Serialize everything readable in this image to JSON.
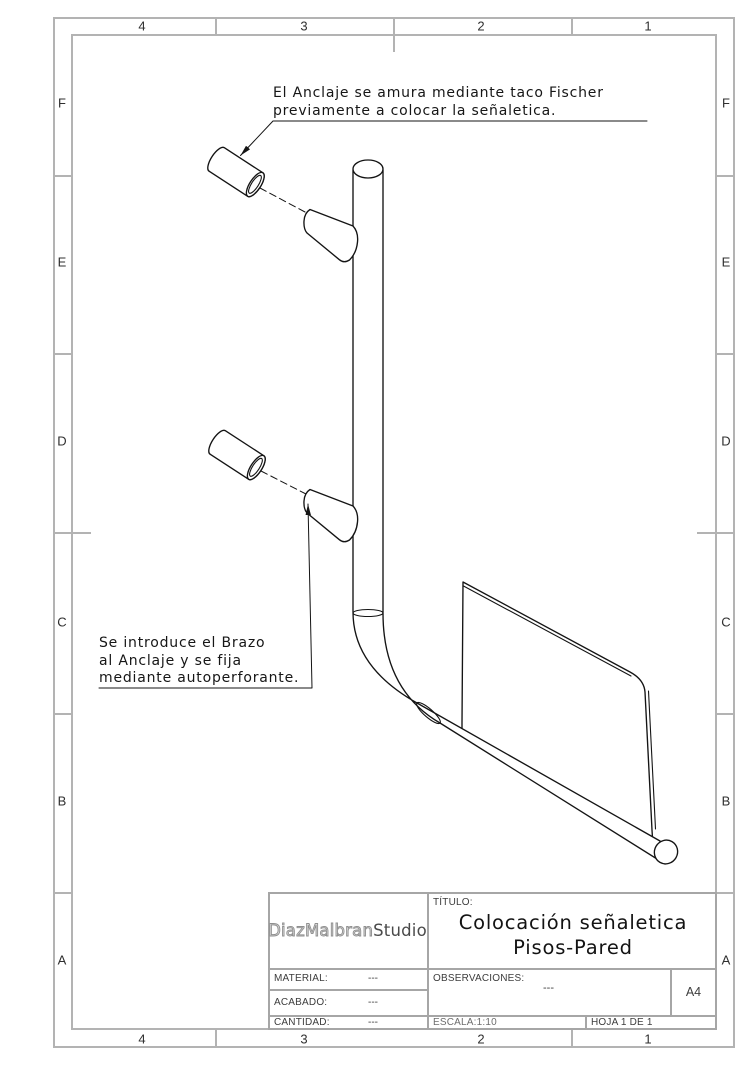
{
  "frame": {
    "columns": [
      "4",
      "3",
      "2",
      "1"
    ],
    "rows": [
      "F",
      "E",
      "D",
      "C",
      "B",
      "A"
    ],
    "border_color": "#b3b3b3"
  },
  "notes": {
    "anchor_note": {
      "line1": "El Anclaje se amura mediante taco Fischer",
      "line2": "previamente a colocar la señaletica."
    },
    "arm_note": {
      "line1": "Se introduce el Brazo",
      "line2": "al Anclaje y se fija",
      "line3": "mediante autoperforante."
    }
  },
  "title_block": {
    "logo": {
      "part1": "DiazMalbran",
      "part2": "Studio"
    },
    "titulo_label": "TÍTULO:",
    "title_line1": "Colocación señaletica",
    "title_line2": "Pisos-Pared",
    "material_label": "MATERIAL:",
    "material_value": "---",
    "acabado_label": "ACABADO:",
    "acabado_value": "---",
    "cantidad_label": "CANTIDAD:",
    "cantidad_value": "---",
    "observaciones_label": "OBSERVACIONES:",
    "observaciones_value": "---",
    "escala": "ESCALA:1:10",
    "hoja": "HOJA 1 DE 1",
    "paper_size": "A4"
  },
  "drawing": {
    "line_color": "#141414",
    "parts": [
      "wall-anchor-top",
      "wall-anchor-bottom",
      "sign-post",
      "sign-panel"
    ]
  }
}
